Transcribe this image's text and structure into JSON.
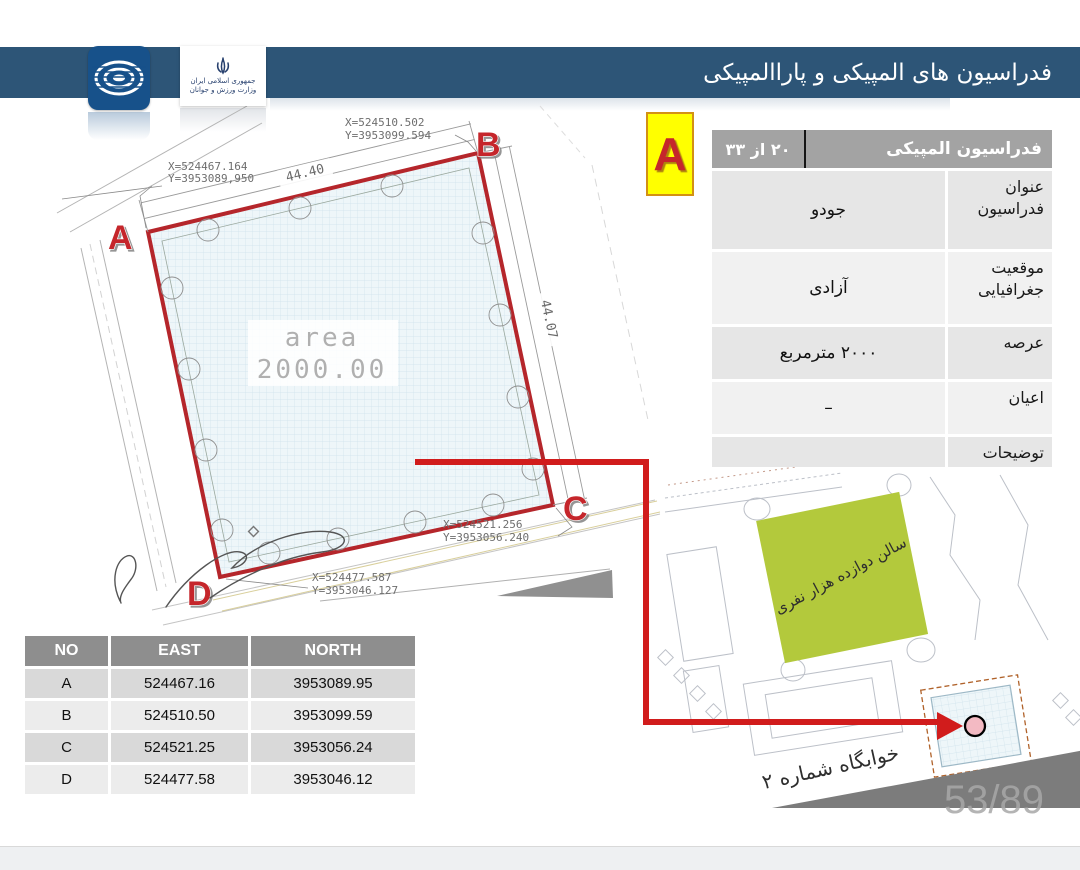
{
  "header": {
    "title": "فدراسیون های المپیکی و پاراالمپیکی",
    "ministry": {
      "line1": "جمهوری اسلامی ایران",
      "line2": "وزارت ورزش و جوانان"
    }
  },
  "badge": {
    "letter": "A"
  },
  "info_table": {
    "title": "فدراسیون المپیکی",
    "page_indicator": "٢٠ از ٣٣",
    "rows": [
      {
        "label": "عنوان فدراسیون",
        "value": "جودو"
      },
      {
        "label": "موقعیت جغرافیایی",
        "value": "آزادی"
      },
      {
        "label": "عرصه",
        "value": "٢٠٠٠ مترمربع"
      },
      {
        "label": "اعیان",
        "value": "–"
      },
      {
        "label": "توضیحات",
        "value": ""
      }
    ]
  },
  "coord_table": {
    "columns": [
      "NO",
      "EAST",
      "NORTH"
    ],
    "rows": [
      {
        "no": "A",
        "east": "524467.16",
        "north": "3953089.95"
      },
      {
        "no": "B",
        "east": "524510.50",
        "north": "3953099.59"
      },
      {
        "no": "C",
        "east": "524521.25",
        "north": "3953056.24"
      },
      {
        "no": "D",
        "east": "524477.58",
        "north": "3953046.12"
      }
    ]
  },
  "drawing": {
    "area_label": "area",
    "area_value": "2000.00",
    "dim_top": "44.40",
    "dim_right": "44.07",
    "corner_a": {
      "letter": "A",
      "x": "X=524467.164",
      "y": "Y=3953089,950"
    },
    "corner_b": {
      "letter": "B",
      "x": "X=524510.502",
      "y": "Y=3953099.594"
    },
    "corner_c": {
      "letter": "C",
      "x": "X=524521.256",
      "y": "Y=3953056.240"
    },
    "corner_d": {
      "letter": "D",
      "x": "X=524477.587",
      "y": "Y=3953046.127"
    }
  },
  "minimap": {
    "hall_label": "سالن دوازده هزار نفری",
    "dorm_label": "خوابگاه شماره ٢"
  },
  "footer": {
    "page_number": "53/89"
  },
  "colors": {
    "header_bg": "#2d5577",
    "boundary_red": "#b5262b",
    "connector_red": "#d11c1c",
    "badge_bg": "#ffff00",
    "hall_green": "#b3c93c",
    "table_header_gray": "#a3a3a3"
  }
}
